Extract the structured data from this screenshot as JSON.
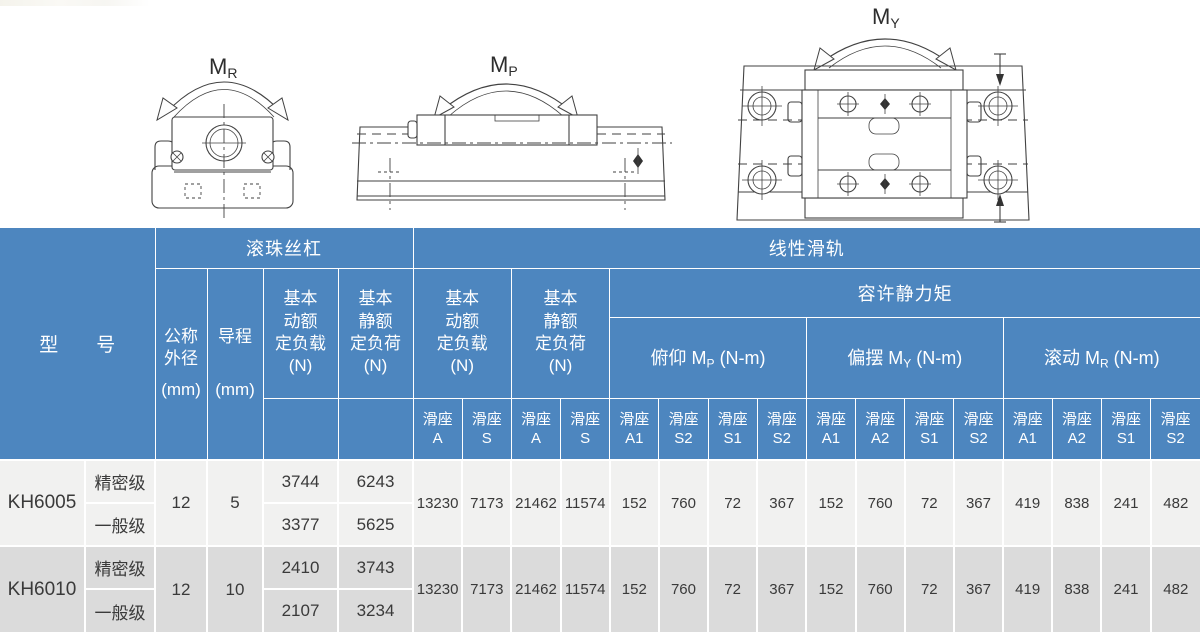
{
  "colors": {
    "header_blue": "#4d86bf",
    "row_light": "#f1f1f0",
    "row_dark": "#dbdbdb",
    "grid_white": "#ffffff"
  },
  "diagrams": {
    "mr": {
      "label": "M",
      "sub": "R"
    },
    "mp": {
      "label": "M",
      "sub": "P"
    },
    "my": {
      "label": "M",
      "sub": "Y"
    }
  },
  "table": {
    "header": {
      "model_label": "型　　号",
      "ball_screw": "滚珠丝杠",
      "linear_rail": "线性滑轨",
      "nominal_od": [
        "公称",
        "外径",
        "(mm)"
      ],
      "lead": [
        "导程",
        "(mm)"
      ],
      "dyn_load": [
        "基本",
        "动额",
        "定负载",
        "(N)"
      ],
      "stat_load": [
        "基本",
        "静额",
        "定负荷",
        "(N)"
      ],
      "moment": "容许静力矩",
      "pitch": {
        "name": "俯仰 M",
        "sub": "P",
        "unit": " (N-m)"
      },
      "yaw": {
        "name": "偏摆 M",
        "sub": "Y",
        "unit": " (N-m)"
      },
      "roll": {
        "name": "滚动 M",
        "sub": "R",
        "unit": " (N-m)"
      },
      "slider": "滑座",
      "slider_codes": [
        "A",
        "S",
        "A",
        "S",
        "A1",
        "S2",
        "S1",
        "S2",
        "A1",
        "A2",
        "S1",
        "S2",
        "A1",
        "A2",
        "S1",
        "S2"
      ]
    },
    "rows": [
      {
        "model": "KH6005",
        "grades": [
          "精密级",
          "一般级"
        ],
        "od": "12",
        "lead": "5",
        "bs_dyn": [
          "3744",
          "3377"
        ],
        "bs_stat": [
          "6243",
          "5625"
        ],
        "lg": [
          "13230",
          "7173",
          "21462",
          "11574"
        ],
        "mp": [
          "152",
          "760",
          "72",
          "367"
        ],
        "my": [
          "152",
          "760",
          "72",
          "367"
        ],
        "mr": [
          "419",
          "838",
          "241",
          "482"
        ]
      },
      {
        "model": "KH6010",
        "grades": [
          "精密级",
          "一般级"
        ],
        "od": "12",
        "lead": "10",
        "bs_dyn": [
          "2410",
          "2107"
        ],
        "bs_stat": [
          "3743",
          "3234"
        ],
        "lg": [
          "13230",
          "7173",
          "21462",
          "11574"
        ],
        "mp": [
          "152",
          "760",
          "72",
          "367"
        ],
        "my": [
          "152",
          "760",
          "72",
          "367"
        ],
        "mr": [
          "419",
          "838",
          "241",
          "482"
        ]
      }
    ]
  }
}
